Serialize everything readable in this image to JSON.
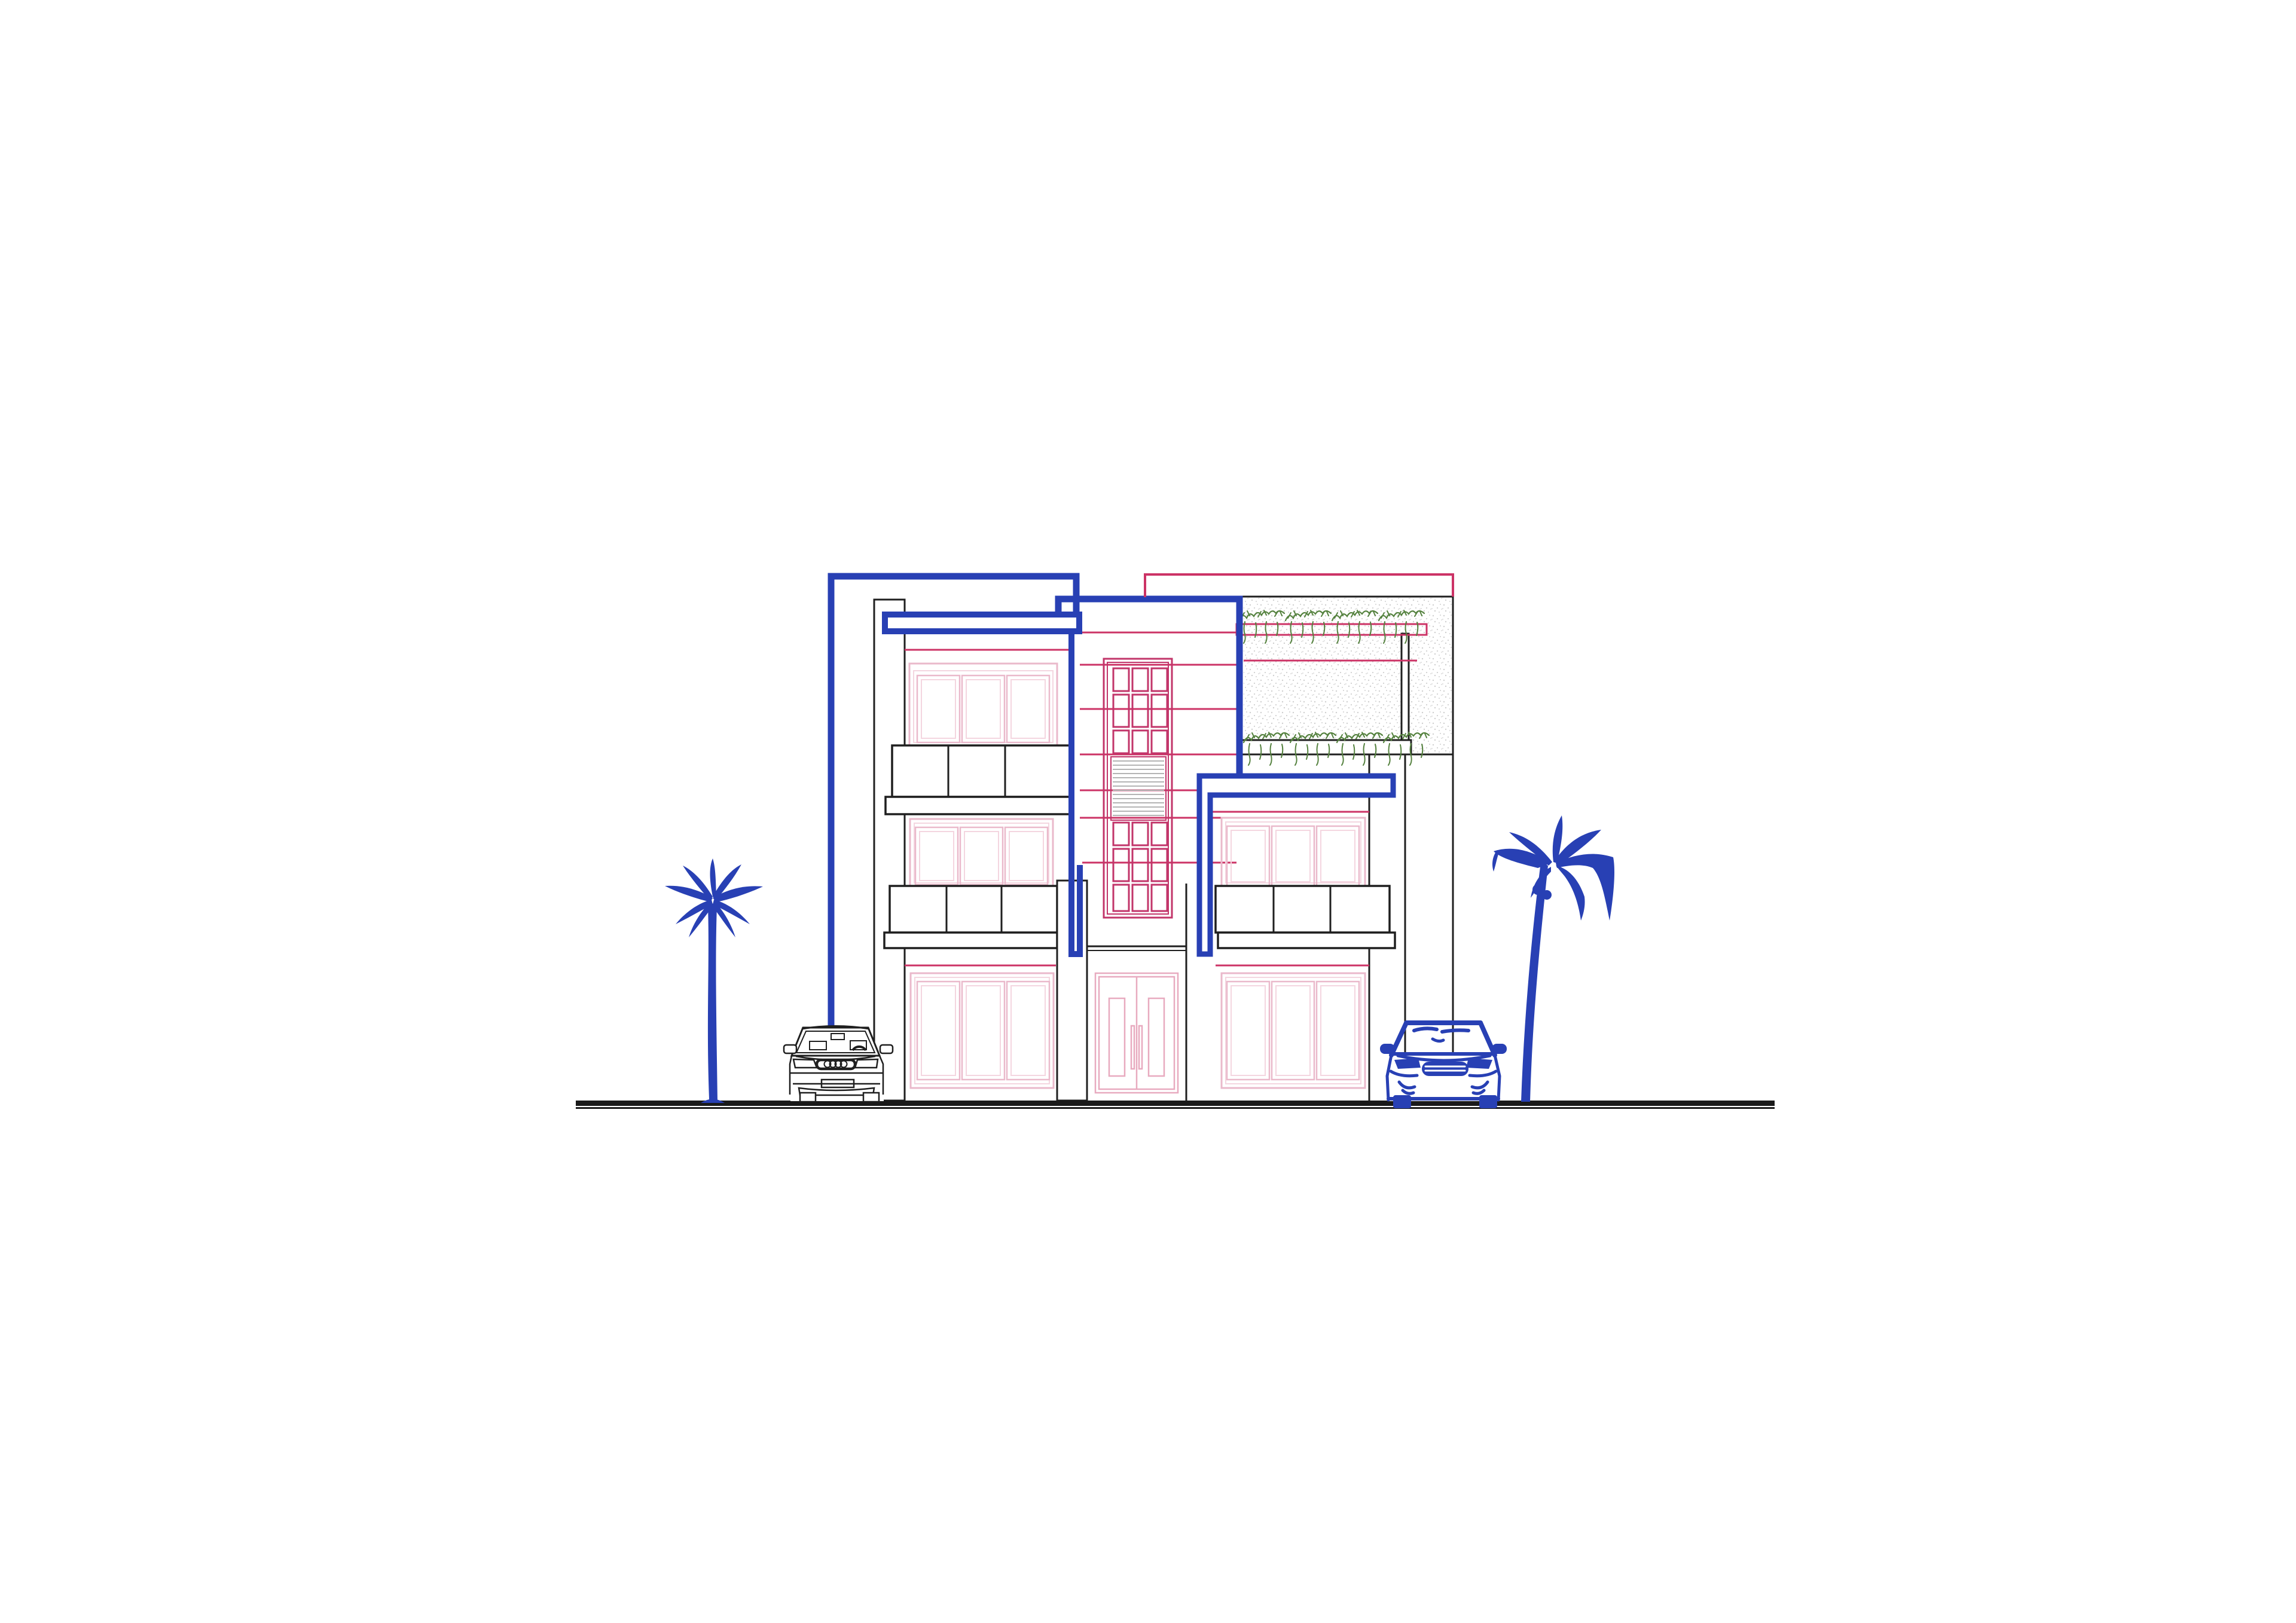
{
  "page": {
    "title": "Modern House Front Elevation — CAD Drawing",
    "background": "#ffffff"
  },
  "colors": {
    "blue": "#2840b4",
    "black": "#1f1f1f",
    "pink": "#cc3366",
    "pink_grid": "#c2356a",
    "pink_light": "#eab9cb",
    "pink_lighter": "#f4d6e0",
    "door_pink": "#e8aabf",
    "green": "#55823f",
    "louver_gray": "#b4b4b4",
    "stipple_gray": "#d0d0d0",
    "ground": "#1a1a1a",
    "white": "#ffffff"
  },
  "scene": {
    "type": "architectural-front-elevation",
    "storeys": 3,
    "left_block": {
      "windows": 3,
      "panes_per_window": 3,
      "balconies": 2,
      "balcony_panels": 3
    },
    "center_tower": {
      "grid_window_columns": 3,
      "grid_window_rows": 6,
      "louver_slats": 13,
      "entrance_door_leaves": 2
    },
    "right_block": {
      "windows": 2,
      "panes_per_window": 3,
      "balconies": 1,
      "roof_garden_vine_rows": 2,
      "pergola_posts": 1
    },
    "site": {
      "palm_trees": 2,
      "cars": 2,
      "ground_line": true
    }
  }
}
